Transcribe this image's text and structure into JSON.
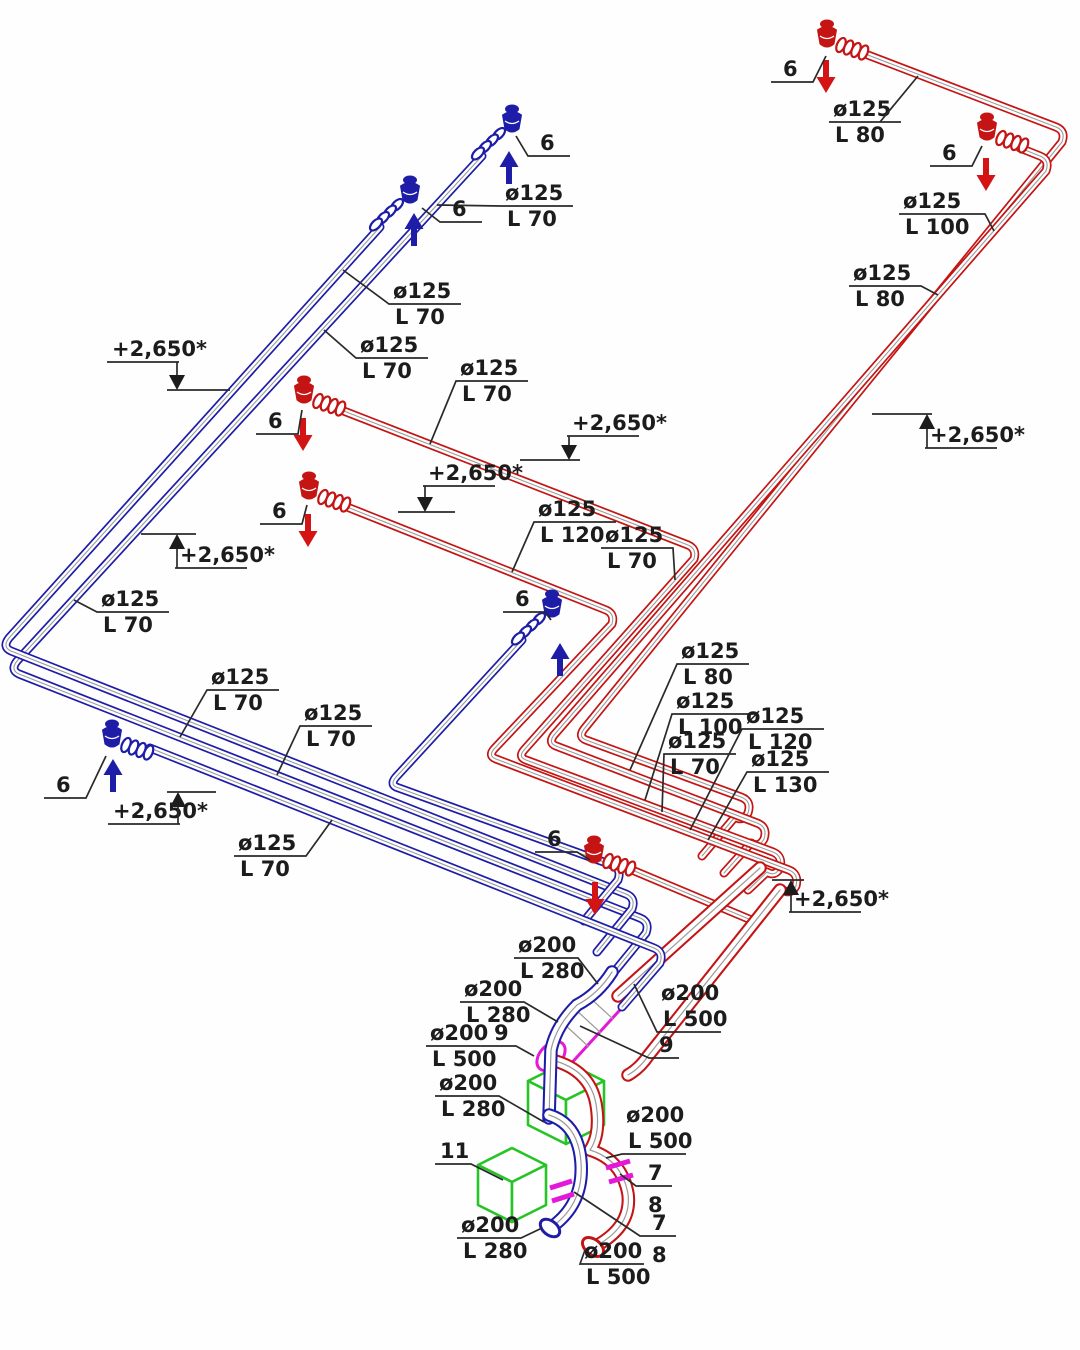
{
  "drawing": {
    "kind": "axonometric-ventilation-piping-scheme",
    "elevation": "+2,650*",
    "numbers": {
      "n6": "6",
      "n7": "7",
      "n8": "8",
      "n9": "9",
      "n11": "11"
    },
    "sizes": {
      "d125": "ø125",
      "d200": "ø200",
      "l70": "L 70",
      "l80": "L 80",
      "l100": "L 100",
      "l120": "L 120",
      "l130": "L 130",
      "l280": "L 280",
      "l500": "L 500"
    },
    "colors": {
      "supply_pipe": "#1d1da8",
      "exhaust_pipe": "#c41414",
      "flexible_transition": "#e318d8",
      "equipment_box": "#27c427",
      "annotation": "#1c1c1c"
    }
  }
}
